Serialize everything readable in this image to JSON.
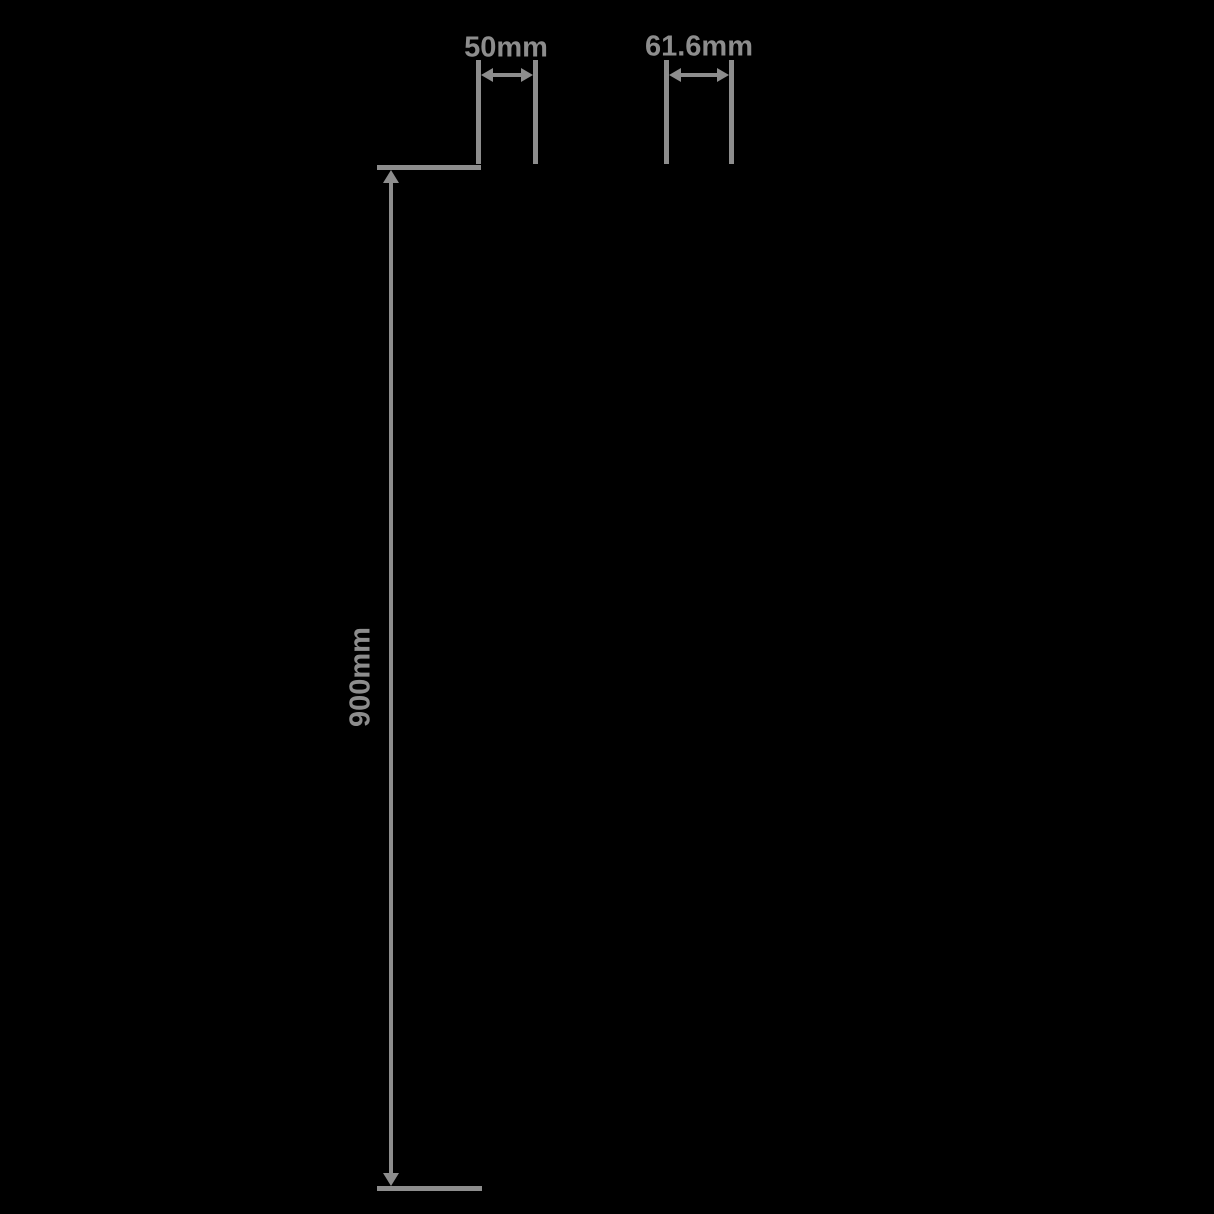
{
  "diagram": {
    "background_color": "#000000",
    "line_color": "#8d8d8d",
    "dimensions": {
      "top_left": {
        "label": "50mm"
      },
      "top_right": {
        "label": "61.6mm"
      },
      "vertical": {
        "label": "900mm"
      }
    }
  }
}
